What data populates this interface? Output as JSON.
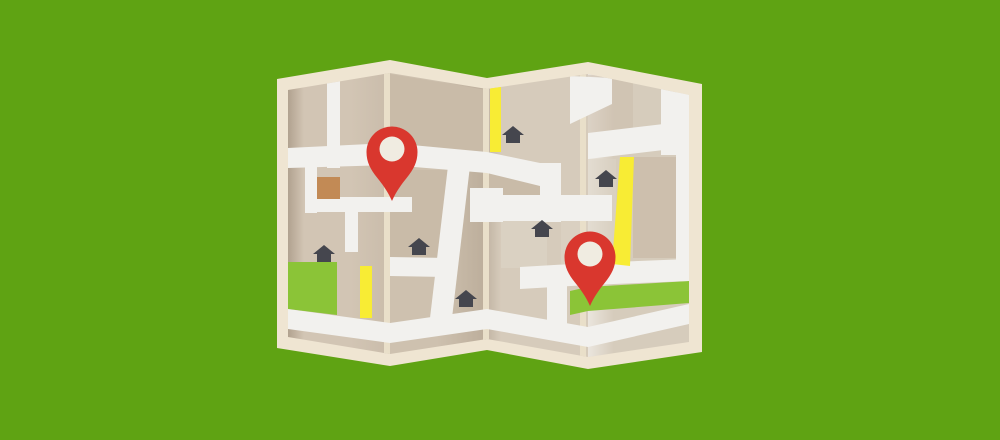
{
  "illustration": {
    "kind": "folded-paper-map",
    "pin_count": 2,
    "house_count": 6
  },
  "colors": {
    "background": "#5FA313",
    "map_border": "#EFE5D2",
    "fold_line": "#E9DFC9",
    "panel_1": "#D2C5B4",
    "panel_2": "#CEC1AF",
    "panel_3": "#D6CBBB",
    "panel_4": "#D6CCBC",
    "block_dark": "#C9BBA8",
    "block_light": "#DCD3C5",
    "road": "#F2F1EE",
    "road_yellow": "#F8EC34",
    "park_green": "#8BC437",
    "pin_red": "#D9372E",
    "pin_hole": "#F0ECE1",
    "house": "#45464E",
    "building": "#C28A55"
  },
  "pins": [
    {
      "label": "map-pin-west",
      "transform": "translate(392,152)"
    },
    {
      "label": "map-pin-east",
      "transform": "translate(590,257)"
    }
  ],
  "houses": [
    {
      "transform": "translate(314,246)"
    },
    {
      "transform": "translate(409,239)"
    },
    {
      "transform": "translate(456,291)"
    },
    {
      "transform": "translate(503,127)"
    },
    {
      "transform": "translate(532,221)"
    },
    {
      "transform": "translate(596,171)"
    }
  ]
}
